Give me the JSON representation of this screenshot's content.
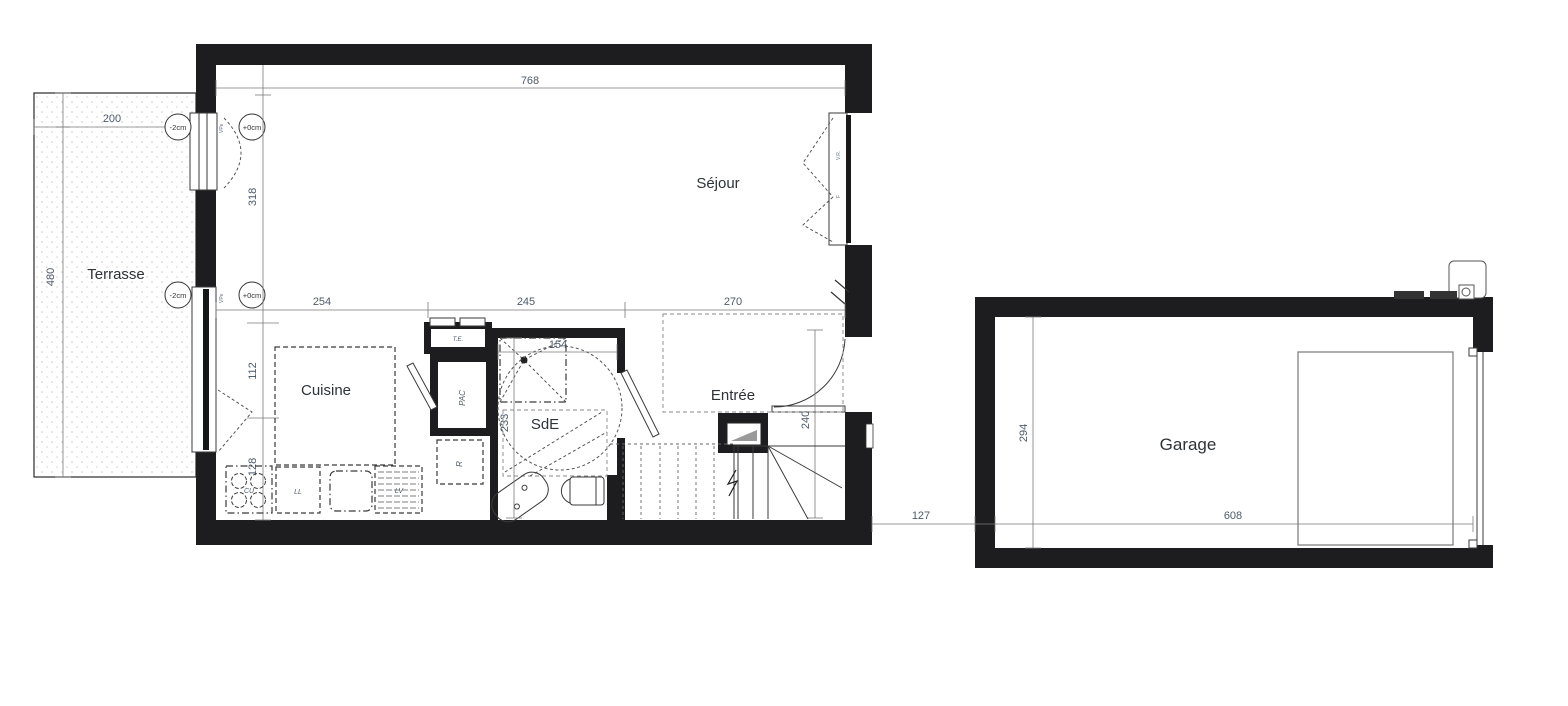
{
  "rooms": {
    "terrasse": "Terrasse",
    "sejour": "Séjour",
    "cuisine": "Cuisine",
    "sde": "SdE",
    "entree": "Entrée",
    "garage": "Garage"
  },
  "dims": {
    "top_width": "768",
    "terrasse_width": "200",
    "terrasse_depth": "480",
    "sejour_height": "318",
    "seg_cuisine": "254",
    "seg_middle": "245",
    "seg_entree": "270",
    "cuisine_upper": "112",
    "cuisine_lower": "128",
    "sde_width": "154",
    "sde_height": "233",
    "entree_height": "240",
    "gap_garage": "127",
    "garage_depth": "294",
    "garage_width": "608"
  },
  "levels": {
    "terrace_top": "-2cm",
    "inside_top": "+0cm",
    "terrace_bottom": "-2cm",
    "inside_bottom": "+0cm"
  },
  "equipment": {
    "te": "T.E.",
    "pac": "PAC",
    "fridge": "R",
    "cooktop": "CU",
    "washer": "LL",
    "dishwasher": "LV"
  },
  "window_tags": {
    "vr": "V.R.",
    "f": "F",
    "vpe_top": "VPe",
    "vpe_bottom": "VPe"
  },
  "colors": {
    "wall": "#1d1d1f",
    "dim_text": "#4e5a68",
    "paper": "#ffffff"
  }
}
